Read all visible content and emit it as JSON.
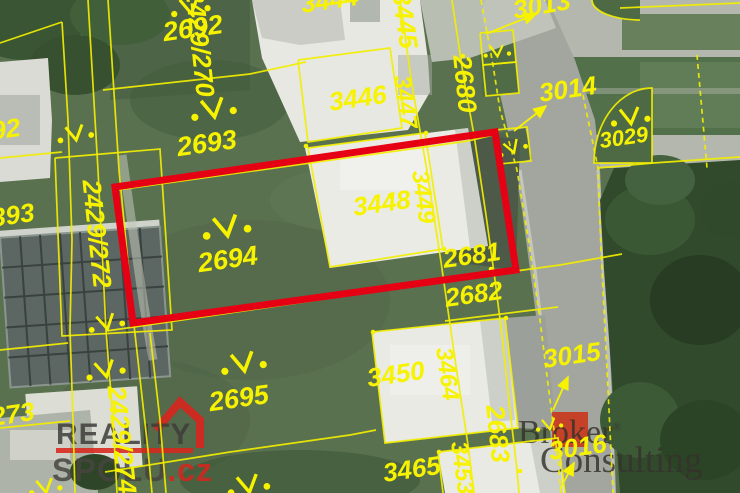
{
  "map": {
    "highlight": {
      "points": "115,187 495,132 516,270 133,323",
      "color": "#e60013"
    },
    "label_color": "#f7f300",
    "labels": [
      {
        "text": "2429/270",
        "x": 198,
        "y": 43,
        "r": 84,
        "s": 26
      },
      {
        "text": "2429/272",
        "x": 95,
        "y": 234,
        "r": 84,
        "s": 26
      },
      {
        "text": "2429/274",
        "x": 120,
        "y": 440,
        "r": 84,
        "s": 26
      },
      {
        "text": "2692",
        "x": 193,
        "y": 30,
        "r": -8,
        "s": 27
      },
      {
        "text": "2693",
        "x": 207,
        "y": 145,
        "r": -8,
        "s": 27
      },
      {
        "text": "2694",
        "x": 228,
        "y": 261,
        "r": -8,
        "s": 27
      },
      {
        "text": "2695",
        "x": 239,
        "y": 400,
        "r": -8,
        "s": 27
      },
      {
        "text": "3444",
        "x": 330,
        "y": 2,
        "r": -8,
        "s": 26
      },
      {
        "text": "3445",
        "x": 403,
        "y": 20,
        "r": 82,
        "s": 26
      },
      {
        "text": "3446",
        "x": 358,
        "y": 100,
        "r": -8,
        "s": 26
      },
      {
        "text": "3447",
        "x": 404,
        "y": 102,
        "r": 82,
        "s": 24
      },
      {
        "text": "3448",
        "x": 382,
        "y": 205,
        "r": -8,
        "s": 26
      },
      {
        "text": "3449",
        "x": 422,
        "y": 197,
        "r": 82,
        "s": 24
      },
      {
        "text": "3450",
        "x": 396,
        "y": 376,
        "r": -8,
        "s": 26
      },
      {
        "text": "3464",
        "x": 446,
        "y": 374,
        "r": 82,
        "s": 24
      },
      {
        "text": "3465",
        "x": 412,
        "y": 471,
        "r": -8,
        "s": 26
      },
      {
        "text": "3453",
        "x": 461,
        "y": 468,
        "r": 82,
        "s": 24
      },
      {
        "text": "2680",
        "x": 463,
        "y": 84,
        "r": 84,
        "s": 26
      },
      {
        "text": "2681",
        "x": 472,
        "y": 257,
        "r": -8,
        "s": 26
      },
      {
        "text": "2682",
        "x": 474,
        "y": 296,
        "r": -8,
        "s": 26
      },
      {
        "text": "2683",
        "x": 496,
        "y": 434,
        "r": 84,
        "s": 26
      },
      {
        "text": "3013",
        "x": 542,
        "y": 7,
        "r": -10,
        "s": 26
      },
      {
        "text": "3014",
        "x": 568,
        "y": 91,
        "r": -8,
        "s": 26
      },
      {
        "text": "3015",
        "x": 572,
        "y": 357,
        "r": -8,
        "s": 26
      },
      {
        "text": "3016",
        "x": 578,
        "y": 449,
        "r": -8,
        "s": 26
      },
      {
        "text": "3029",
        "x": 624,
        "y": 139,
        "r": -8,
        "s": 22
      },
      {
        "text": "92",
        "x": 6,
        "y": 131,
        "r": -8,
        "s": 26
      },
      {
        "text": "393",
        "x": 13,
        "y": 217,
        "r": -8,
        "s": 26
      },
      {
        "text": "273",
        "x": 13,
        "y": 416,
        "r": -8,
        "s": 26
      }
    ],
    "symbols": [
      [
        190,
        6,
        -10,
        1.3
      ],
      [
        213,
        108,
        -10,
        1.5
      ],
      [
        226,
        226,
        -10,
        1.6
      ],
      [
        106,
        322,
        -12,
        1.2
      ],
      [
        105,
        369,
        -12,
        1.3
      ],
      [
        75,
        133,
        -10,
        1.2
      ],
      [
        243,
        362,
        -10,
        1.5
      ],
      [
        248,
        484,
        -10,
        1.4
      ],
      [
        630,
        116,
        -8,
        1.3
      ],
      [
        497,
        51,
        -5,
        0.9
      ],
      [
        512,
        147,
        -20,
        1.0
      ],
      [
        549,
        424,
        -10,
        0.9
      ],
      [
        45,
        486,
        -10,
        1.1
      ]
    ],
    "arrows": [
      [
        486,
        34,
        536,
        14
      ],
      [
        514,
        131,
        546,
        106
      ],
      [
        553,
        410,
        568,
        377
      ],
      [
        560,
        489,
        574,
        463
      ]
    ]
  },
  "watermarks": {
    "reality": {
      "line1": "REALITY",
      "line2": "SPOLU",
      "tld": ".cz"
    },
    "broker": {
      "word1": "Broker",
      "reg": "®",
      "word2": "Consulting"
    }
  }
}
